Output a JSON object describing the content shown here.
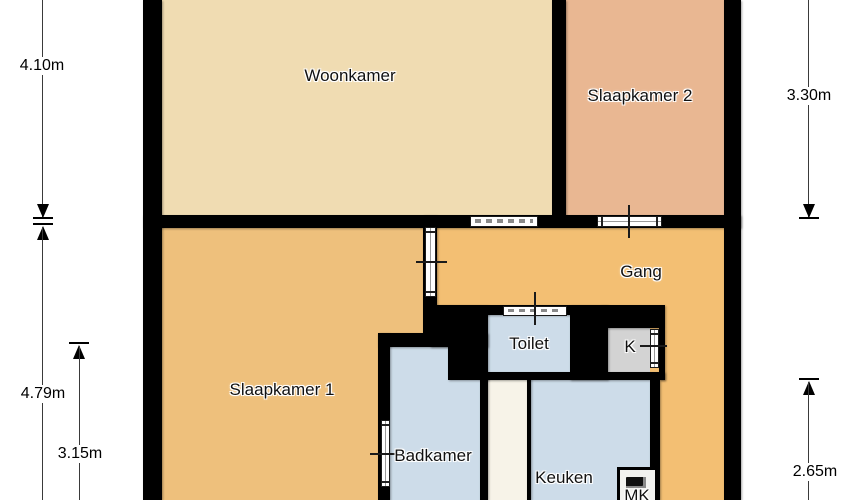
{
  "rooms": {
    "woonkamer": {
      "label": "Woonkamer"
    },
    "slaapkamer2": {
      "label": "Slaapkamer 2"
    },
    "gang": {
      "label": "Gang"
    },
    "slaapkamer1": {
      "label": "Slaapkamer 1"
    },
    "toilet": {
      "label": "Toilet"
    },
    "kast": {
      "label": "K"
    },
    "badkamer": {
      "label": "Badkamer"
    },
    "keuken": {
      "label": "Keuken"
    },
    "meterkast": {
      "label": "MK"
    }
  },
  "dimensions": {
    "left_top": {
      "label": "4.10m"
    },
    "left_bottom_outer": {
      "label": "4.79m"
    },
    "left_bottom_inner": {
      "label": "3.15m"
    },
    "right_top": {
      "label": "3.30m"
    },
    "right_bottom": {
      "label": "2.65m"
    }
  },
  "colors": {
    "woonkamer": "#f0dcb2",
    "slaapkamer2": "#e9b792",
    "slaapkamer1": "#eec07c",
    "gang": "#f3bf73",
    "wet_rooms": "#cddce9",
    "closet": "#d3d3d3",
    "shaft": "#f7f3e8",
    "wall": "#000000",
    "background": "#ffffff"
  }
}
